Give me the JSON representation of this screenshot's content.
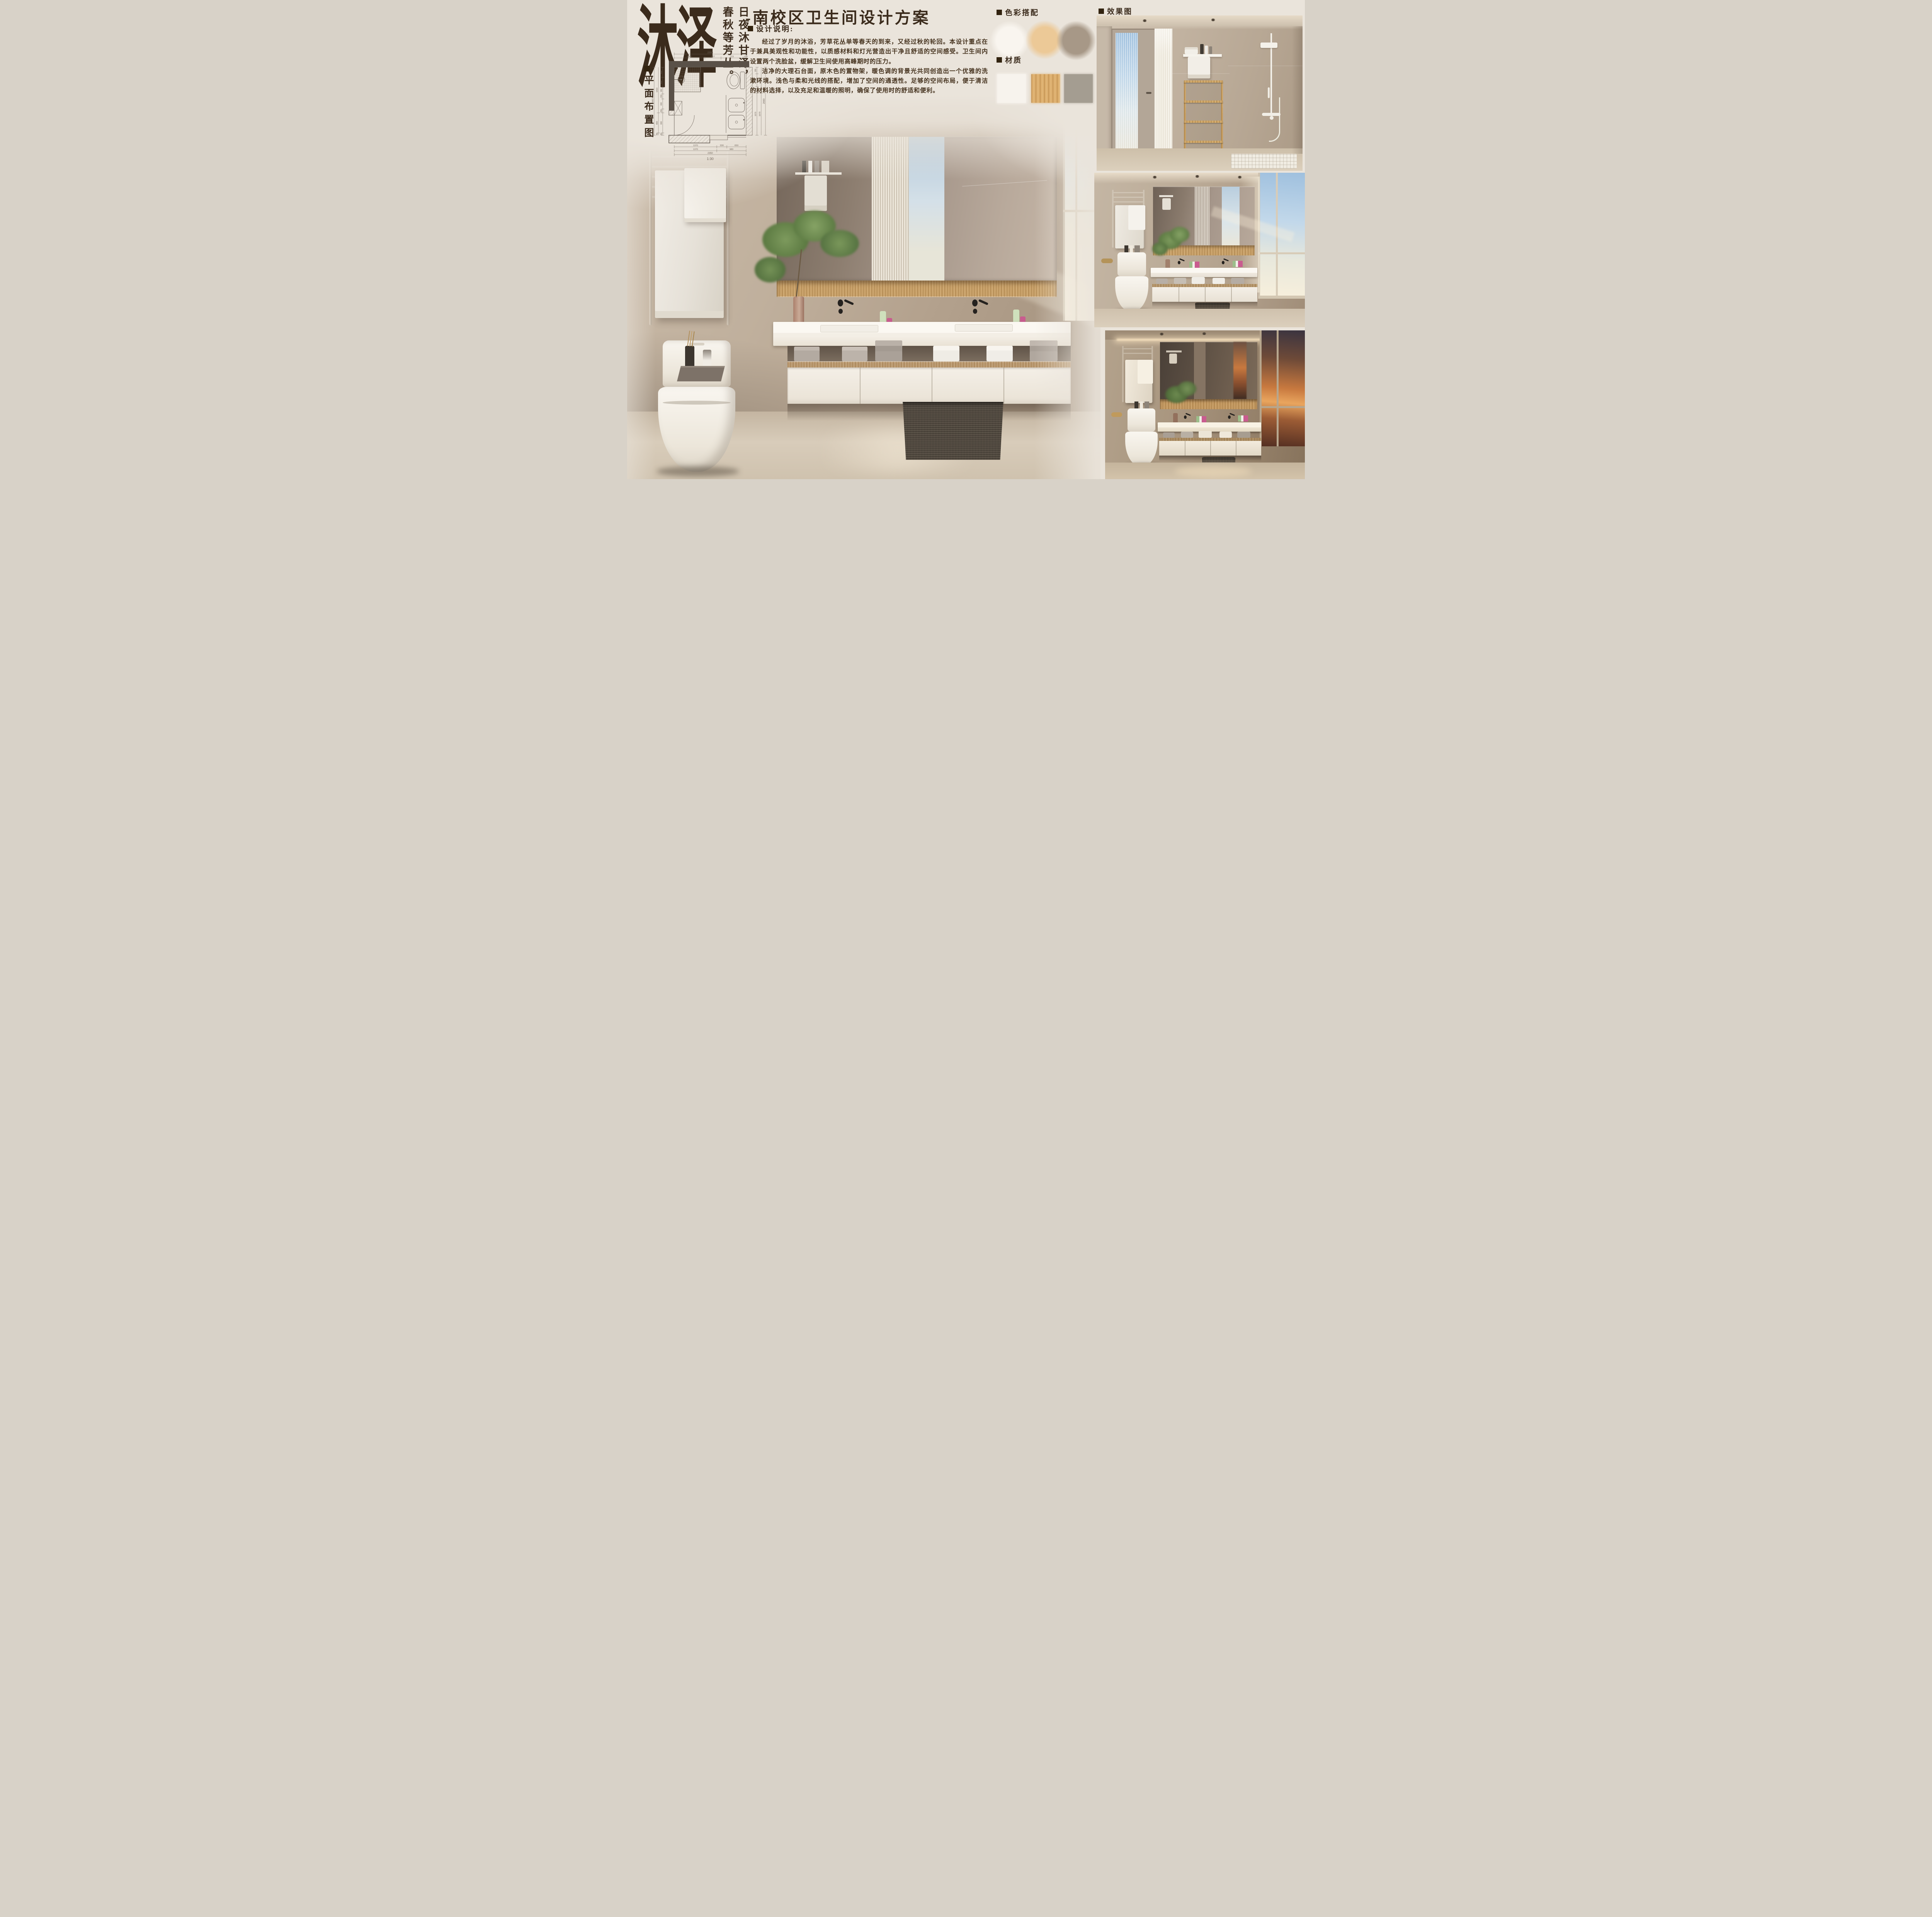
{
  "meta": {
    "background": "#EAE4DB",
    "ink": "#3B2B1C"
  },
  "logo": {
    "wordmark": "沐泽",
    "slogan_col_right": "日夜沐甘泽，",
    "slogan_col_left": "春秋等芳丛。"
  },
  "floor_plan": {
    "label": "平面布置图",
    "scale_label": "1:30",
    "dim_top_total": "2350",
    "dim_top": [
      "1000",
      "527",
      "723",
      "100"
    ],
    "dim_left_total": "2690",
    "dim_left_mid": [
      "1810",
      "800",
      "80"
    ],
    "dim_left": [
      "400",
      "400",
      "260",
      "200",
      "400",
      "150",
      "800",
      "80"
    ],
    "dim_right": [
      "255",
      "511",
      "255",
      "1670"
    ],
    "dim_right_mid": [
      "1020",
      "1670"
    ],
    "dim_right_total": "2690",
    "dim_bottom": [
      "1370",
      "330",
      "650"
    ],
    "dim_bottom_mid": [
      "1370",
      "980"
    ],
    "dim_bottom_total": "2350"
  },
  "header": {
    "title": "-南校区卫生间设计方案"
  },
  "design_notes": {
    "heading": "设计说明:",
    "paragraph_1": "经过了岁月的沐浴，芳草花丛单等春天的到来，又经过秋的轮回。本设计重点在于兼具美观性和功能性，以质感材料和灯光营造出干净且舒适的空间感受。卫生间内设置两个洗脸盆，缓解卫生间使用高峰期时的压力。",
    "paragraph_2": "洁净的大理石台面，原木色的置物架，暖色调的背景光共同创造出一个优雅的洗漱环境。浅色与柔和光线的搭配，增加了空间的通透性。足够的空间布局，便于清洁的材料选择，以及充足和温暖的照明，确保了使用时的舒适和便利。"
  },
  "color_scheme": {
    "heading": "色彩搭配",
    "swatch_1": "#F9F5EF",
    "swatch_2": "#ECC997",
    "swatch_3": "#A79887"
  },
  "materials": {
    "heading": "材质",
    "swatch_1": "#F7F3ED",
    "swatch_2": "#DCAE6D",
    "swatch_3": "#A49D91"
  },
  "renders": {
    "heading": "效果图"
  }
}
